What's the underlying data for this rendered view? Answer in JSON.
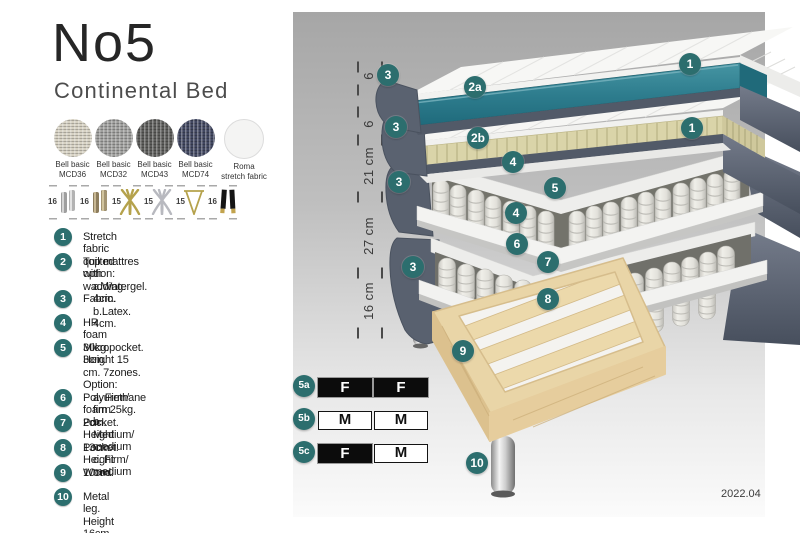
{
  "header": {
    "title": "No5",
    "subtitle": "Continental Bed"
  },
  "fabrics": [
    {
      "line1": "Bell basic",
      "line2": "MCD36"
    },
    {
      "line1": "Bell basic",
      "line2": "MCD32"
    },
    {
      "line1": "Bell basic",
      "line2": "MCD43"
    },
    {
      "line1": "Bell basic",
      "line2": "MCD74"
    },
    {
      "line1": "Roma",
      "line2": "stretch fabric"
    }
  ],
  "legs": [
    {
      "height": "16",
      "icon": "cylinder-legs-silver"
    },
    {
      "height": "16",
      "icon": "cylinder-legs-bronze"
    },
    {
      "height": "15",
      "icon": "cross-legs-gold"
    },
    {
      "height": "15",
      "icon": "cross-legs-silver"
    },
    {
      "height": "15",
      "icon": "hairpin-leg-gold"
    },
    {
      "height": "16",
      "icon": "tapered-legs-black-gold"
    }
  ],
  "list": [
    {
      "num": "1",
      "lines": [
        "Stretch fabric quilted with wadding."
      ]
    },
    {
      "num": "2",
      "lines": [
        "Top mattres option:",
        "a.Watergel. 4cm.",
        "b.Latex. 4cm."
      ]
    },
    {
      "num": "3",
      "lines": [
        "Fabric."
      ]
    },
    {
      "num": "4",
      "lines": [
        "HR foam 30kg. 3cm."
      ]
    },
    {
      "num": "5",
      "lines": [
        "Micropocket. Height 15 cm. 7zones. Option:",
        "a. Firm/ firm",
        "b. Medium/ medium",
        "c. Firm/ medium"
      ]
    },
    {
      "num": "6",
      "lines": [
        "Polyurethane foam 25kg. 2cm."
      ]
    },
    {
      "num": "7",
      "lines": [
        "Pocket. Height 13cm."
      ]
    },
    {
      "num": "8",
      "lines": [
        "Pocket. Height 10cm."
      ]
    },
    {
      "num": "9",
      "lines": [
        "Wood."
      ]
    },
    {
      "num": "10",
      "lines": [
        "Metal leg. Height 16cm."
      ]
    }
  ],
  "diagram": {
    "dimensions": [
      "6",
      "6",
      "21 cm",
      "27 cm",
      "16 cm"
    ],
    "badges": [
      {
        "label": "1"
      },
      {
        "label": "1"
      },
      {
        "label": "2a"
      },
      {
        "label": "2b"
      },
      {
        "label": "3"
      },
      {
        "label": "3"
      },
      {
        "label": "3"
      },
      {
        "label": "3"
      },
      {
        "label": "4"
      },
      {
        "label": "4"
      },
      {
        "label": "5"
      },
      {
        "label": "6"
      },
      {
        "label": "7"
      },
      {
        "label": "8"
      },
      {
        "label": "9"
      },
      {
        "label": "10"
      }
    ],
    "firmness": [
      {
        "id": "5a",
        "left": {
          "label": "F",
          "style": "dark"
        },
        "right": {
          "label": "F",
          "style": "dark"
        }
      },
      {
        "id": "5b",
        "left": {
          "label": "M",
          "style": "light"
        },
        "right": {
          "label": "M",
          "style": "light"
        }
      },
      {
        "id": "5c",
        "left": {
          "label": "F",
          "style": "dark"
        },
        "right": {
          "label": "M",
          "style": "light"
        }
      }
    ],
    "revision": "2022.04",
    "accent_teal": "#2c6e6e",
    "watergel_color": "#2e7d8e",
    "latex_color": "#dad4a9"
  }
}
